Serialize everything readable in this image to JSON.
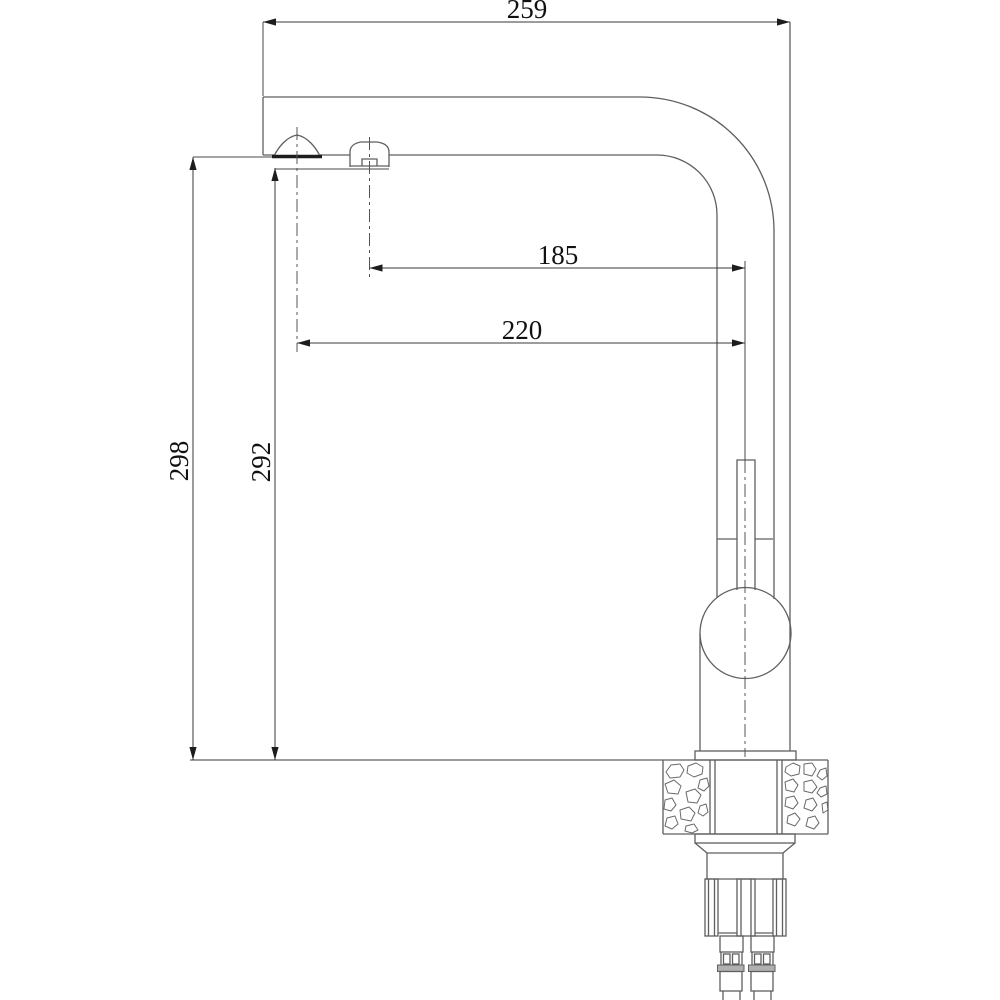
{
  "drawing": {
    "subject": "kitchen-faucet-side-view-dimensional-drawing",
    "dimensions": {
      "overall_reach": {
        "label": "259",
        "orientation": "horizontal"
      },
      "secondary_outlet_reach": {
        "label": "185",
        "orientation": "horizontal"
      },
      "main_outlet_reach": {
        "label": "220",
        "orientation": "horizontal"
      },
      "main_outlet_height": {
        "label": "298",
        "orientation": "vertical"
      },
      "secondary_outlet_height": {
        "label": "292",
        "orientation": "vertical"
      }
    },
    "colors": {
      "background": "#ffffff",
      "line": "#5f5f5f",
      "dimension_line": "#3a3a3a",
      "text": "#111111",
      "hose_band": "#b0b0b0",
      "aerator_face": "#1d1d1d"
    }
  }
}
